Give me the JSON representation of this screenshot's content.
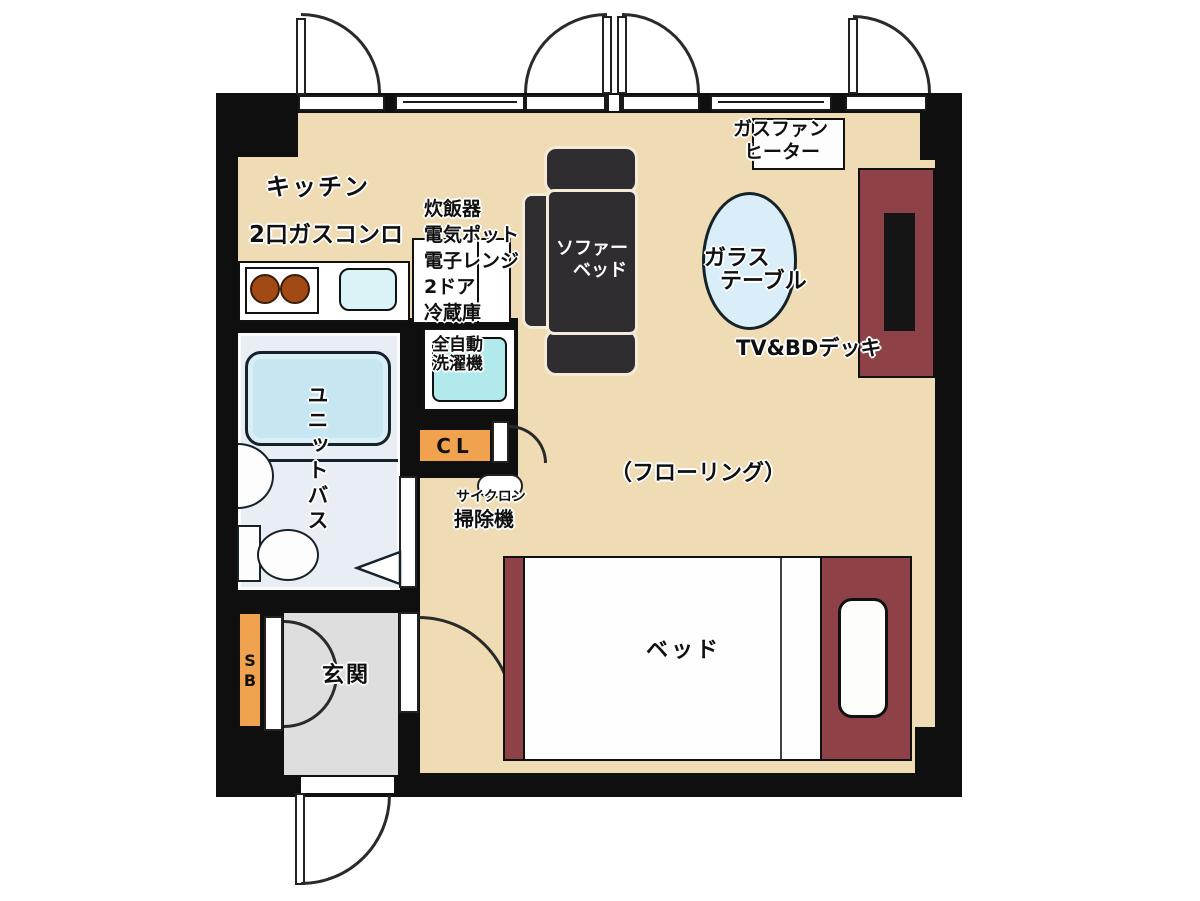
{
  "floor_plan": {
    "kitchen": {
      "name": "キッチン",
      "equipment": "2口ガスコンロ"
    },
    "appliance_stack": [
      "炊飯器",
      "電気ポット",
      "電子レンジ",
      "2ドア",
      "冷蔵庫"
    ],
    "washer": {
      "line1": "全自動",
      "line2": "洗濯機"
    },
    "sofa_bed": {
      "line1": "ソファー",
      "line2": "ベッド"
    },
    "gas_fan_heater": {
      "line1": "ガスファン",
      "line2": "ヒーター"
    },
    "glass_table": {
      "line1": "ガラス",
      "line2": "テーブル"
    },
    "tv_bd_deck": {
      "label": "TV&BDデッキ"
    },
    "closet": {
      "label": "CL"
    },
    "vacuum": {
      "line1": "サイクロン",
      "line2": "掃除機"
    },
    "main_room": {
      "label": "（フローリング）"
    },
    "unit_bath": {
      "label": "ユニットバス"
    },
    "shoe_box": {
      "line1": "S",
      "line2": "B"
    },
    "entrance": {
      "label": "玄関"
    },
    "bed": {
      "label": "ベッド"
    },
    "colors": {
      "wall": "#0f0f0f",
      "room_floor": "#f0dcb4",
      "entrance_floor": "#dedede",
      "bath_floor": "#e9eef5",
      "bathtub": "#c6e6f2",
      "accent_orange": "#f0a24e",
      "bed_frame": "#8e4247",
      "sofa": "#2f2d30",
      "washer_cyan": "#b2e9ec",
      "table_blue": "#d9eef8",
      "burner_brown": "#a24a16"
    }
  }
}
